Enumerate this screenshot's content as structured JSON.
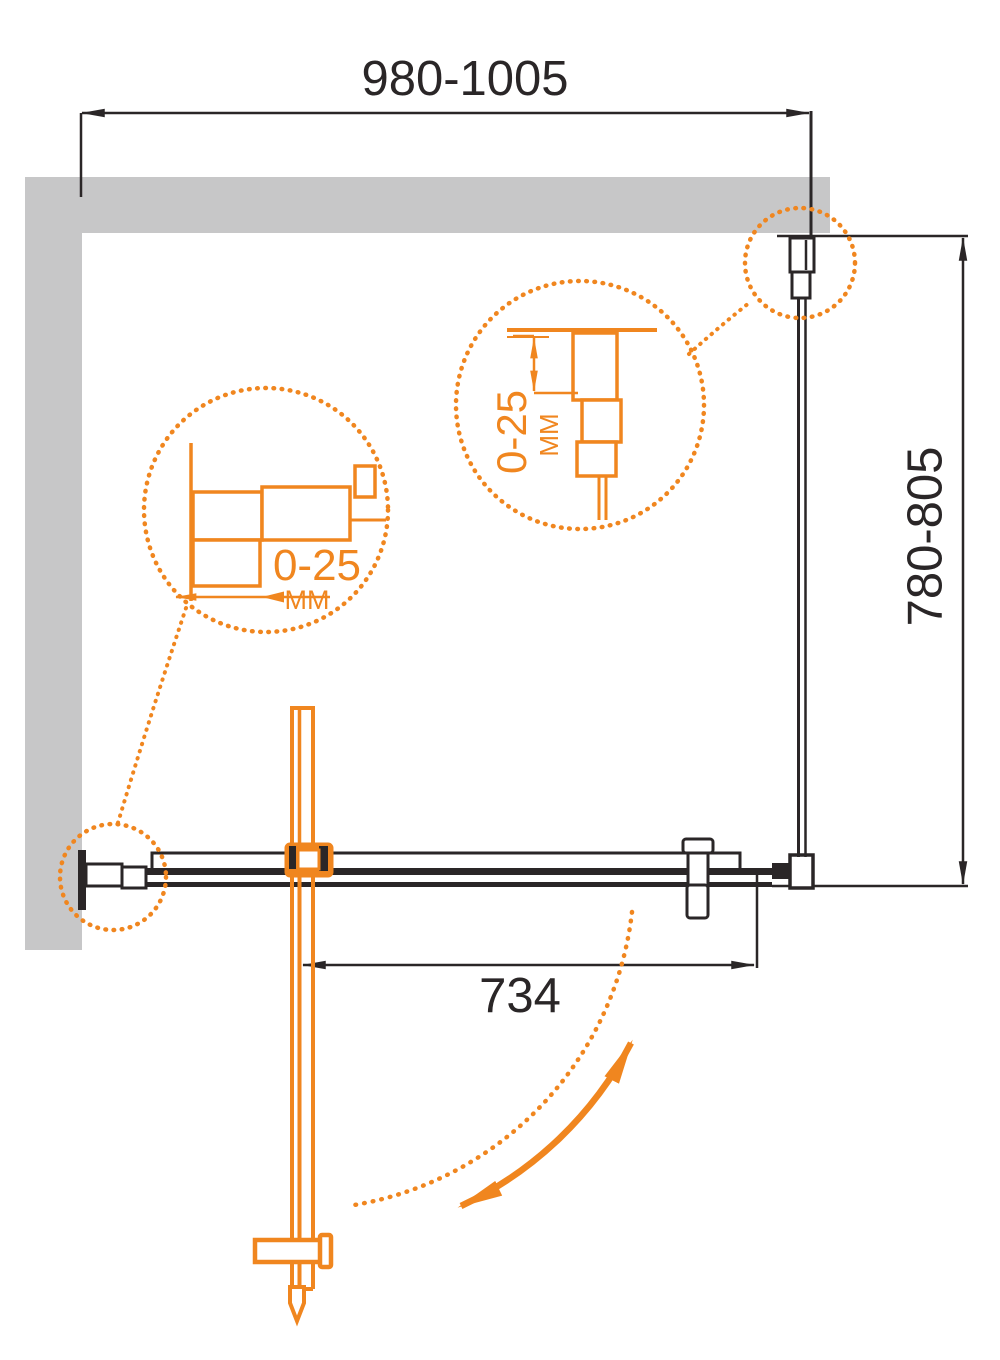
{
  "drawing": {
    "type": "shower-enclosure-installation-plan",
    "dimensions": {
      "width_range": "980-1005",
      "depth_range": "780-805",
      "door_opening": "734"
    },
    "detail_left": {
      "adjust_range": "0-25",
      "unit": "MM"
    },
    "detail_top": {
      "adjust_range": "0-25",
      "unit": "MM"
    },
    "colors": {
      "accent_orange": "#f0861f",
      "wall_gray": "#c7c7c8",
      "line_black": "#2a2627"
    }
  }
}
